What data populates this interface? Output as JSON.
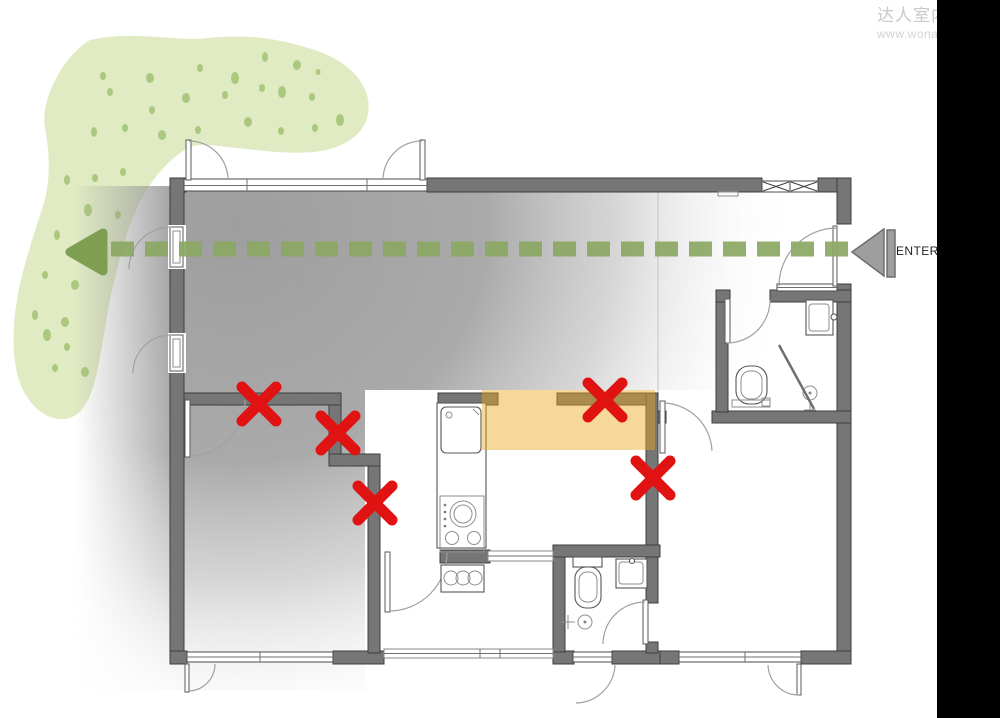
{
  "watermark": {
    "brand": "达人室内",
    "url": "www.wona"
  },
  "entry_label": "ENTER",
  "colors": {
    "blob_green": "#e0eac3",
    "dot_green": "#abc97e",
    "route_green": "#8ba863",
    "arrowhead_green": "#7e9e51",
    "wall_gray": "#767676",
    "wall_outline": "#3e3e3e",
    "zone_gray": "#979797",
    "highlight_orange": "rgba(235,170,30,0.45)",
    "x_red": "#e01212",
    "enter_gray": "#9e9e9e",
    "sidebar_black": "#000000",
    "watermark_gray": "#c9c9c9"
  }
}
